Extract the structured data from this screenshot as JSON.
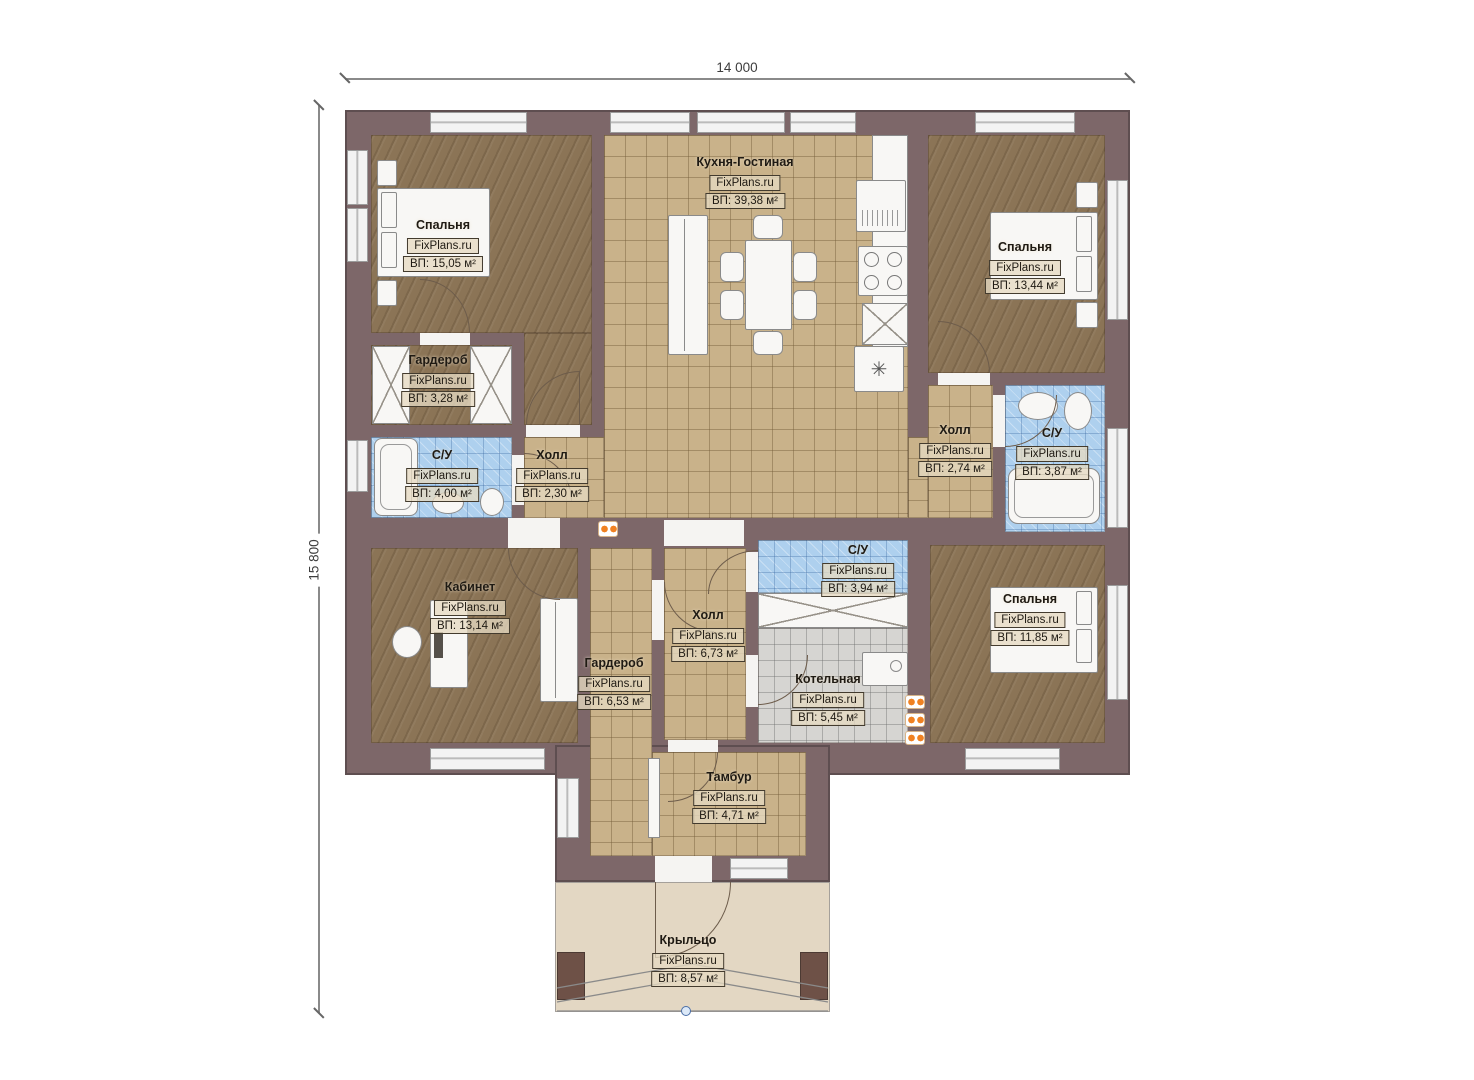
{
  "source_brand": "FixPlans.ru",
  "dimensions": {
    "width_label": "14 000",
    "height_label": "15 800"
  },
  "rooms": [
    {
      "name": "Спальня",
      "brand": "FixPlans.ru",
      "area": "ВП: 15,05 м²"
    },
    {
      "name": "Кухня-Гостиная",
      "brand": "FixPlans.ru",
      "area": "ВП: 39,38 м²"
    },
    {
      "name": "Спальня",
      "brand": "FixPlans.ru",
      "area": "ВП: 13,44 м²"
    },
    {
      "name": "Гардероб",
      "brand": "FixPlans.ru",
      "area": "ВП: 3,28 м²"
    },
    {
      "name": "С/У",
      "brand": "FixPlans.ru",
      "area": "ВП: 4,00 м²"
    },
    {
      "name": "Холл",
      "brand": "FixPlans.ru",
      "area": "ВП: 2,30 м²"
    },
    {
      "name": "Холл",
      "brand": "FixPlans.ru",
      "area": "ВП: 2,74 м²"
    },
    {
      "name": "С/У",
      "brand": "FixPlans.ru",
      "area": "ВП: 3,87 м²"
    },
    {
      "name": "Кабинет",
      "brand": "FixPlans.ru",
      "area": "ВП: 13,14 м²"
    },
    {
      "name": "Гардероб",
      "brand": "FixPlans.ru",
      "area": "ВП: 6,53 м²"
    },
    {
      "name": "Холл",
      "brand": "FixPlans.ru",
      "area": "ВП: 6,73 м²"
    },
    {
      "name": "С/У",
      "brand": "FixPlans.ru",
      "area": "ВП: 3,94 м²"
    },
    {
      "name": "Котельная",
      "brand": "FixPlans.ru",
      "area": "ВП: 5,45 м²"
    },
    {
      "name": "Спальня",
      "brand": "FixPlans.ru",
      "area": "ВП: 11,85 м²"
    },
    {
      "name": "Тамбур",
      "brand": "FixPlans.ru",
      "area": "ВП: 4,71 м²"
    },
    {
      "name": "Крыльцо",
      "brand": "FixPlans.ru",
      "area": "ВП: 8,57 м²"
    }
  ],
  "colors": {
    "wall": "#7d6769",
    "wood_floor": "#8b7456",
    "tile_floor": "#c9b28a",
    "wet_floor": "#aed0ee",
    "boiler_floor": "#d6d5d2",
    "porch_floor": "#e3d7c3",
    "radiator": "#f08122",
    "dimension_text": "#3d3d3d"
  }
}
